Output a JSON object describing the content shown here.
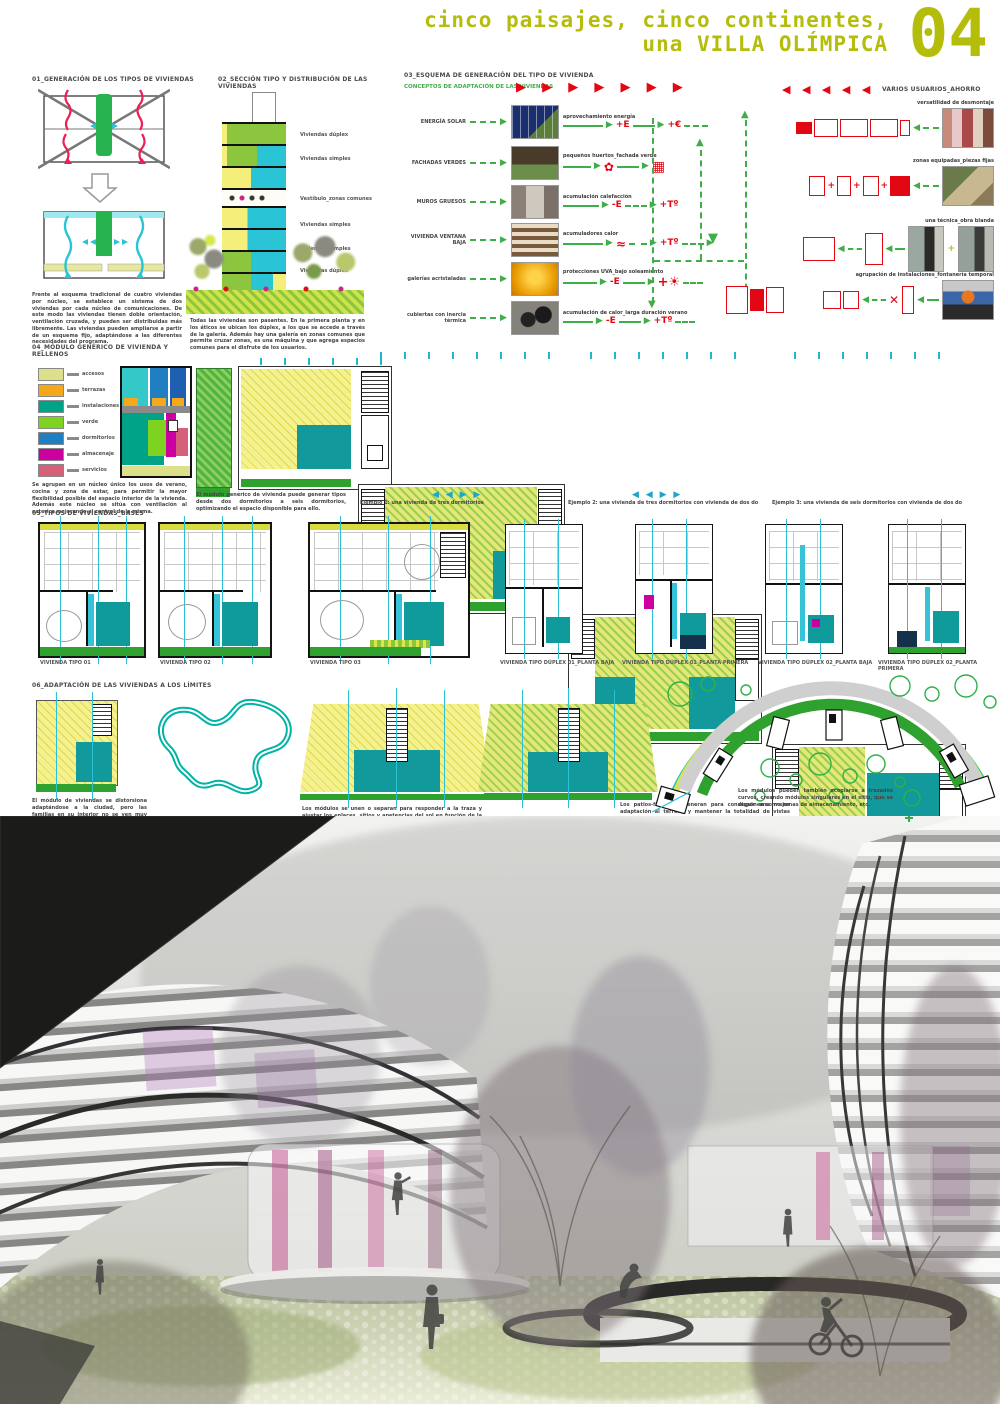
{
  "header": {
    "title_line1": "cinco paisajes, cinco continentes,",
    "title_line2": "una VILLA OLÍMPICA",
    "panel_number": "04",
    "accent_color": "#b5bd0b"
  },
  "palette": {
    "green_arrow": "#3fae49",
    "red": "#e30613",
    "cyan": "#2bc0d4",
    "teal": "#0f9b9b",
    "lime": "#7cc43e",
    "yellow_hatch": "#efe96d"
  },
  "sections": {
    "s01": {
      "title": "01_GENERACIÓN DE LOS TIPOS DE VIVIENDAS",
      "caption": "Frente al esquema tradicional de cuatro viviendas por núcleo, se establece un sistema de dos viviendas por cada núcleo de comunicaciones. De este modo las viviendas tienen doble orientación, ventilación cruzada, y pueden ser distribuidas más libremente. Las viviendas pueden ampliarse a partir de un esquema fijo, adaptándose a las diferentes necesidades del programa."
    },
    "s02": {
      "title": "02_SECCIÓN TIPO Y DISTRIBUCIÓN DE LAS VIVIENDAS",
      "floor_labels": [
        "Viviendas dúplex",
        "Viviendas simples",
        "Vestíbulo_zonas comunes",
        "Viviendas simples",
        "Viviendas simples",
        "Viviendas dúplex"
      ],
      "caption": "Todas las viviendas son pasantes. En la primera planta y en los áticos se ubican los dúplex, a los que se accede a través de la galería. Además hay una galería en zonas comunes que permite cruzar zonas, es una máquina y que agrega espacios comunes para el disfrute de los usuarios."
    },
    "s03": {
      "title": "03_ESQUEMA DE GENERACIÓN DEL TIPO DE VIVIENDA",
      "subtitle": "CONCEPTOS DE ADAPTACIÓN DE LAS VIVIENDAS",
      "arrows_right": "▶ ▶ ▶ ▶ ▶ ▶ ▶",
      "arrows_left": "◀ ◀ ◀ ◀ ◀",
      "right_title": "VARIOS USUARIOS_AHORRO",
      "left_rows": [
        {
          "label": "ENERGÍA SOLAR",
          "tag": "aprovechamiento energía",
          "sym1": "+E",
          "sym2": "+€"
        },
        {
          "label": "FACHADAS VERDES",
          "tag": "pequeños huertos_fachada verde",
          "sym1": "✿",
          "sym2": "▦"
        },
        {
          "label": "MUROS GRUESOS",
          "tag": "acumulación calefacción",
          "sym1": "-E",
          "sym2": "+Tº"
        },
        {
          "label": "VIVIENDA VENTANA BAJA",
          "tag": "acumuladores calor",
          "sym1": "≈",
          "sym2": "+Tº"
        },
        {
          "label": "galerías acristaladas",
          "tag": "protecciones UVA_bajo soleamiento",
          "sym1": "-E",
          "sym2": "+☀"
        },
        {
          "label": "cubiertas con inercia térmica",
          "tag": "acumulación de calor_larga duración verano",
          "sym1": "-E",
          "sym2": "+Tº"
        }
      ],
      "right_rows": [
        {
          "label": "versatilidad de desmontaje"
        },
        {
          "label": "zonas equipadas_piezas fijas"
        },
        {
          "label": "una técnica_obra blanda"
        },
        {
          "label": "agrupación de instalaciones_fontanería temporal"
        }
      ]
    },
    "s04": {
      "title": "04_MÓDULO GENÉRICO DE VIVIENDA Y RELLENOS",
      "legend": [
        {
          "color": "#dde08a",
          "label": "accesos"
        },
        {
          "color": "#f5a81c",
          "label": "terrazas"
        },
        {
          "color": "#00a388",
          "label": "instalaciones"
        },
        {
          "color": "#7ed321",
          "label": "verde"
        },
        {
          "color": "#1f7fc0",
          "label": "dormitorios"
        },
        {
          "color": "#cc00a0",
          "label": "almacenaje"
        },
        {
          "color": "#d4607a",
          "label": "servicios"
        }
      ],
      "caption": "Se agrupan en un núcleo único los usos de verano, cocina y zona de estar, para permitir la mayor flexibilidad posible del espacio interior de la vivienda. Además este núcleo se sitúa con ventilación al exterior mejorando el control de la misma."
    },
    "examples": {
      "cap0": "El módulo genérico de vivienda puede generar tipos desde dos dormitorios a seis dormitorios, optimizando el espacio disponible para ello.",
      "cap1": "Ejemplo 1: una vivienda de tres dormitorios",
      "cap2": "Ejemplo 2: una vivienda de tres dormitorios con vivienda de dos dormitorios",
      "cap3": "Ejemplo 3: una vivienda de seis dormitorios con vivienda de dos dormitorios",
      "arrows": "◀ ◀ ▶ ▶"
    },
    "s05": {
      "title": "05_TIPOS DE VIVIENDAS_BASES",
      "labels": [
        "VIVIENDA TIPO 01",
        "VIVIENDA TIPO 02",
        "VIVIENDA TIPO 03",
        "VIVIENDA TIPO DÚPLEX 01_PLANTA BAJA",
        "VIVIENDA TIPO DÚPLEX 01_PLANTA PRIMERA",
        "VIVIENDA TIPO DÚPLEX 02_PLANTA BAJA",
        "VIVIENDA TIPO DÚPLEX 02_PLANTA PRIMERA"
      ]
    },
    "s06": {
      "title": "06_ADAPTACIÓN DE LAS VIVIENDAS A LOS LÍMITES",
      "cap_a": "El módulo de viviendas se distorsiona adaptándose a la ciudad, pero las familias en su interior no se ven muy afectadas, y la vivienda es muy flexible.",
      "cap_b": "Los módulos se unen o separan para responder a la traza y ajustar los enlaces, sitios y apetencias del sol en función de la orientación de la fachada.",
      "cap_c": "Los patios-fuelle se generan para conseguir una mejor adaptación al terreno y mantener la totalidad de vistas entre las viviendas.",
      "cap_d": "Los módulos pueden también acoplarse a trazados curvos, creando módulos singulares en el sitio, que se disponen como zonas de almacenamiento, etc."
    }
  }
}
